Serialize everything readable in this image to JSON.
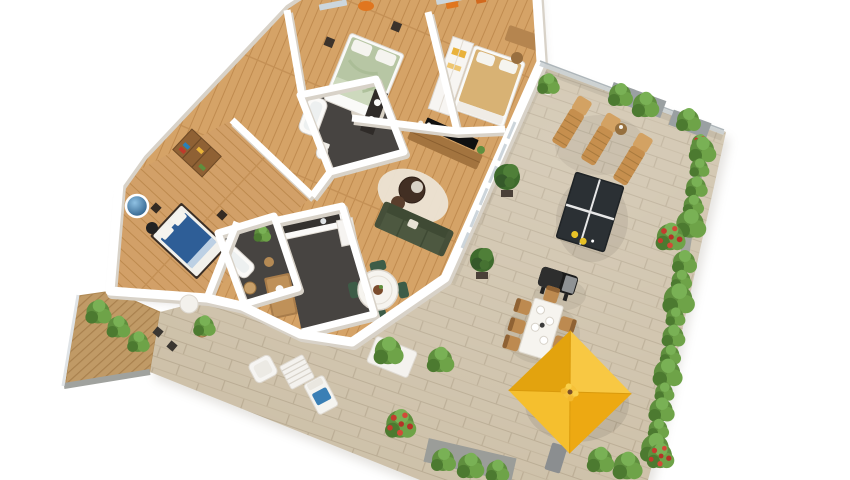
{
  "scene": {
    "title": "3D isometric floor plan of a three-bedroom apartment with a large wrap-around terrace",
    "background": "#ffffff"
  },
  "palette": {
    "wall": "#ffffff",
    "wall_shadow": "#d8d2c8",
    "wood_floor": "#d5a367",
    "wood_plank_line": "#c08b4f",
    "terrace_tile": "#cdc0a8",
    "tile_line": "#b6a88f",
    "dark_floor": "#474441",
    "deck_wood": "#c09a66",
    "sofa_green": "#4d5840",
    "bed_green": "#b7c6a4",
    "bed_blue": "#2e5e97",
    "bed_beige": "#d8b274",
    "umbrella_yellow": "#f2b71e",
    "plant_green": "#5f8f3e",
    "plant_dark": "#3e6b2d",
    "flower_red": "#c43b2e",
    "lounger_wood": "#c68f4e",
    "table_white": "#f6f4ef",
    "tv_black": "#101010",
    "accent_orange": "#e0761f",
    "glass_railing": "#cdd3d6"
  },
  "apartment": {
    "rooms": [
      {
        "name": "master-bedroom",
        "floor": "wood",
        "furniture": [
          "green double bed",
          "white pillows",
          "nightstands",
          "round rug",
          "orange wall art",
          "windows"
        ]
      },
      {
        "name": "bedroom-2",
        "floor": "wood",
        "furniture": [
          "beige double bed",
          "white wardrobe with yellow accents",
          "wooden desk",
          "chair",
          "orange wall art"
        ]
      },
      {
        "name": "bedroom-3",
        "floor": "wood",
        "furniture": [
          "blue double bed",
          "wooden bookshelf",
          "nightstands",
          "round blue wall art",
          "black desk chair"
        ]
      },
      {
        "name": "ensuite-bathroom",
        "floor": "dark-tile",
        "furniture": [
          "bathtub",
          "toilet",
          "dark vanity with twin basins"
        ]
      },
      {
        "name": "bathroom-2",
        "floor": "dark-tile",
        "furniture": [
          "bathtub",
          "potted plant",
          "wooden stool",
          "wicker basket"
        ]
      },
      {
        "name": "kitchen",
        "floor": "dark-tile",
        "furniture": [
          "white counter with dark top and sink",
          "wooden island",
          "tall white cabinet"
        ]
      },
      {
        "name": "dining-area",
        "floor": "wood",
        "furniture": [
          "round white table",
          "four dark-green chairs",
          "centerpiece"
        ]
      },
      {
        "name": "living-room",
        "floor": "wood",
        "furniture": [
          "dark green sofa",
          "wooden TV console",
          "flat TV",
          "round dark coffee tables",
          "cream rug",
          "indoor plant"
        ]
      }
    ]
  },
  "terrace": {
    "floor": "stone tiles",
    "items": [
      "glass railing",
      "three wooden sun loungers",
      "small side table",
      "ping-pong table with yellow paddles",
      "black BBQ grill",
      "outdoor dining table with six wooden chairs",
      "square yellow parasol",
      "white armchair",
      "white slatted low table",
      "white lounger with blue towel",
      "white pouf",
      "planter boxes with hedges",
      "cypress pots",
      "red flowering bushes",
      "wooden deck with planters",
      "two dark deck stools"
    ]
  }
}
